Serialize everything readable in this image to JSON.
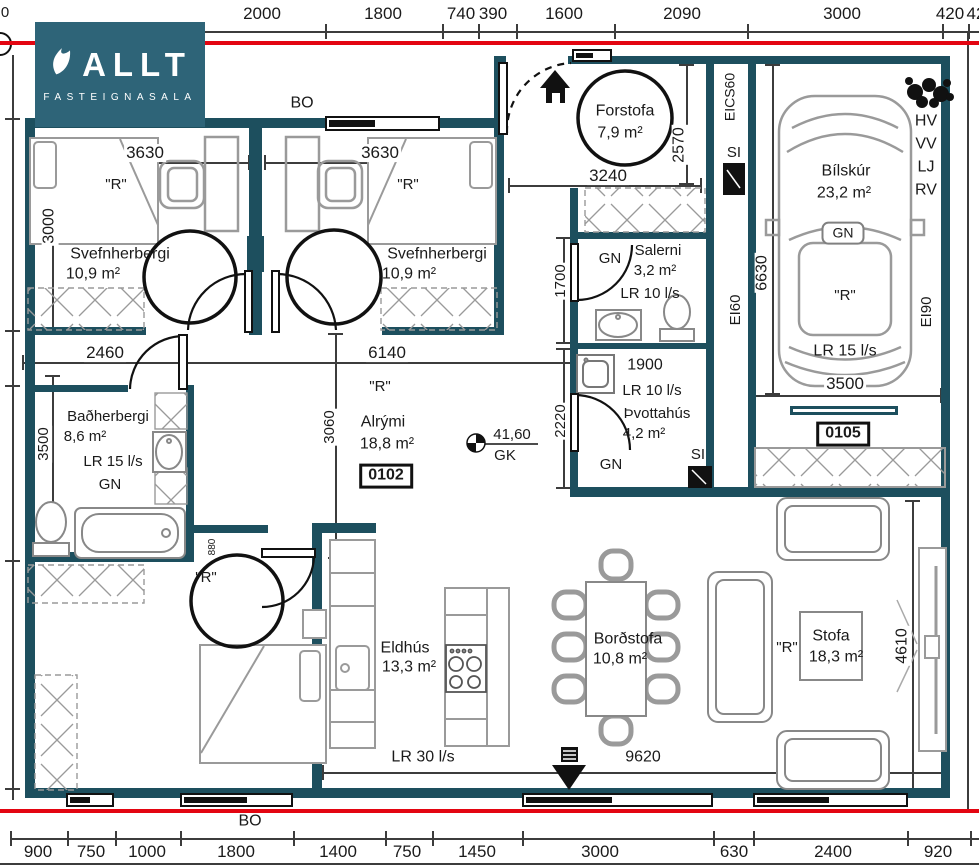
{
  "logo": {
    "brand": "ALLT",
    "sub": "FASTEIGNASALA"
  },
  "colors": {
    "wall": "#1d4f5e",
    "logo_bg": "#2e6478",
    "red_line": "#e30511",
    "furniture": "#9a9a9a"
  },
  "annotations": [
    {
      "n": "dim-top-2000",
      "t": "2000",
      "x": 262,
      "y": 14,
      "s": 17
    },
    {
      "n": "dim-top-1800",
      "t": "1800",
      "x": 383,
      "y": 14,
      "s": 17
    },
    {
      "n": "dim-top-740",
      "t": "740",
      "x": 461,
      "y": 14,
      "s": 17
    },
    {
      "n": "dim-top-390",
      "t": "390",
      "x": 493,
      "y": 14,
      "s": 17
    },
    {
      "n": "dim-top-1600",
      "t": "1600",
      "x": 564,
      "y": 14,
      "s": 17
    },
    {
      "n": "dim-top-2090",
      "t": "2090",
      "x": 682,
      "y": 14,
      "s": 17
    },
    {
      "n": "dim-top-3000",
      "t": "3000",
      "x": 842,
      "y": 14,
      "s": 17
    },
    {
      "n": "dim-top-420",
      "t": "420",
      "x": 950,
      "y": 14,
      "s": 17
    },
    {
      "n": "dim-top-partial",
      "t": "42",
      "x": 976,
      "y": 14,
      "s": 17
    },
    {
      "n": "dim-left-partial",
      "t": "0",
      "x": 5,
      "y": 13,
      "s": 15
    },
    {
      "n": "label-bo-top",
      "t": "BO",
      "x": 302,
      "y": 104,
      "s": 16
    },
    {
      "n": "dim-3630-left",
      "t": "3630",
      "x": 145,
      "y": 153,
      "s": 17,
      "bg": 1
    },
    {
      "n": "dim-3630-right",
      "t": "3630",
      "x": 380,
      "y": 153,
      "s": 17,
      "bg": 1
    },
    {
      "n": "dim-3000-left",
      "t": "3000",
      "x": 50,
      "y": 226,
      "s": 16,
      "r": -90,
      "bg": 1
    },
    {
      "n": "label-r-bedroom1",
      "t": "\"R\"",
      "x": 116,
      "y": 185,
      "s": 15
    },
    {
      "n": "label-r-bedroom2",
      "t": "\"R\"",
      "x": 408,
      "y": 185,
      "s": 15
    },
    {
      "n": "room-svefnherbergi1",
      "t": "Svefnherbergi",
      "x": 120,
      "y": 255,
      "s": 16
    },
    {
      "n": "area-svefnherbergi1",
      "t": "10,9 m²",
      "x": 93,
      "y": 275,
      "s": 16
    },
    {
      "n": "room-svefnherbergi2",
      "t": "Svefnherbergi",
      "x": 437,
      "y": 255,
      "s": 16
    },
    {
      "n": "area-svefnherbergi2",
      "t": "10,9 m²",
      "x": 409,
      "y": 275,
      "s": 16
    },
    {
      "n": "room-forstofa",
      "t": "Forstofa",
      "x": 625,
      "y": 112,
      "s": 16
    },
    {
      "n": "area-forstofa",
      "t": "7,9 m²",
      "x": 620,
      "y": 134,
      "s": 16
    },
    {
      "n": "dim-3240",
      "t": "3240",
      "x": 608,
      "y": 176,
      "s": 17,
      "bg": 1
    },
    {
      "n": "dim-2570",
      "t": "2570",
      "x": 680,
      "y": 145,
      "s": 16,
      "r": -90,
      "bg": 1
    },
    {
      "n": "label-eics60",
      "t": "EICS60",
      "x": 730,
      "y": 97,
      "s": 14,
      "r": -90
    },
    {
      "n": "label-si-top",
      "t": "SI",
      "x": 734,
      "y": 153,
      "s": 15
    },
    {
      "n": "room-bilskur",
      "t": "Bílskúr",
      "x": 846,
      "y": 172,
      "s": 16
    },
    {
      "n": "area-bilskur",
      "t": "23,2 m²",
      "x": 844,
      "y": 194,
      "s": 16
    },
    {
      "n": "label-gn-car",
      "t": "GN",
      "x": 843,
      "y": 233,
      "s": 14,
      "box": "car"
    },
    {
      "n": "label-r-bilskur",
      "t": "\"R\"",
      "x": 845,
      "y": 296,
      "s": 15
    },
    {
      "n": "label-lr15-bilskur",
      "t": "LR 15 l/s",
      "x": 845,
      "y": 352,
      "s": 16
    },
    {
      "n": "dim-6630",
      "t": "6630",
      "x": 763,
      "y": 273,
      "s": 16,
      "r": -90,
      "bg": 1
    },
    {
      "n": "dim-3500-garage",
      "t": "3500",
      "x": 845,
      "y": 384,
      "s": 17,
      "bg": 1
    },
    {
      "n": "label-ei60",
      "t": "EI60",
      "x": 736,
      "y": 310,
      "s": 15,
      "r": -90
    },
    {
      "n": "label-ei90",
      "t": "EI90",
      "x": 927,
      "y": 312,
      "s": 15,
      "r": -90
    },
    {
      "n": "label-hv",
      "t": "HV",
      "x": 926,
      "y": 122,
      "s": 16
    },
    {
      "n": "label-vv",
      "t": "VV",
      "x": 926,
      "y": 145,
      "s": 16
    },
    {
      "n": "label-lj",
      "t": "LJ",
      "x": 926,
      "y": 168,
      "s": 16
    },
    {
      "n": "label-rv",
      "t": "RV",
      "x": 926,
      "y": 191,
      "s": 16
    },
    {
      "n": "num-0105",
      "t": "0105",
      "x": 843,
      "y": 434,
      "s": 16,
      "box": "num"
    },
    {
      "n": "label-gn-salerni",
      "t": "GN",
      "x": 610,
      "y": 259,
      "s": 15
    },
    {
      "n": "room-salerni",
      "t": "Salerni",
      "x": 658,
      "y": 251,
      "s": 15
    },
    {
      "n": "area-salerni",
      "t": "3,2 m²",
      "x": 655,
      "y": 271,
      "s": 15
    },
    {
      "n": "label-lr10-salerni",
      "t": "LR 10 l/s",
      "x": 650,
      "y": 294,
      "s": 15
    },
    {
      "n": "dim-1700",
      "t": "1700",
      "x": 561,
      "y": 281,
      "s": 15,
      "r": -90,
      "bg": 1
    },
    {
      "n": "dim-1900",
      "t": "1900",
      "x": 645,
      "y": 366,
      "s": 16,
      "bg": 1
    },
    {
      "n": "label-lr10-thvottahus",
      "t": "LR 10 l/s",
      "x": 652,
      "y": 391,
      "s": 15,
      "bg": 1
    },
    {
      "n": "room-thvottahus",
      "t": "Þvottahús",
      "x": 657,
      "y": 414,
      "s": 15
    },
    {
      "n": "area-thvottahus",
      "t": "4,2 m²",
      "x": 644,
      "y": 434,
      "s": 15
    },
    {
      "n": "label-gn-thvottahus",
      "t": "GN",
      "x": 611,
      "y": 465,
      "s": 15
    },
    {
      "n": "label-si-thvottahus",
      "t": "SI",
      "x": 698,
      "y": 455,
      "s": 15
    },
    {
      "n": "dim-2220",
      "t": "2220",
      "x": 561,
      "y": 421,
      "s": 15,
      "r": -90,
      "bg": 1
    },
    {
      "n": "dim-2460",
      "t": "2460",
      "x": 105,
      "y": 353,
      "s": 17,
      "bg": 1
    },
    {
      "n": "dim-6140",
      "t": "6140",
      "x": 387,
      "y": 353,
      "s": 17,
      "bg": 1
    },
    {
      "n": "label-r-alrymi",
      "t": "\"R\"",
      "x": 380,
      "y": 387,
      "s": 15
    },
    {
      "n": "room-alrymi",
      "t": "Alrými",
      "x": 383,
      "y": 423,
      "s": 16
    },
    {
      "n": "area-alrymi",
      "t": "18,8 m²",
      "x": 387,
      "y": 445,
      "s": 16
    },
    {
      "n": "num-0102",
      "t": "0102",
      "x": 386,
      "y": 476,
      "s": 16,
      "box": "num"
    },
    {
      "n": "label-level-41-60",
      "t": "41,60",
      "x": 512,
      "y": 435,
      "s": 15
    },
    {
      "n": "label-gk",
      "t": "GK",
      "x": 505,
      "y": 456,
      "s": 15
    },
    {
      "n": "dim-3060",
      "t": "3060",
      "x": 330,
      "y": 427,
      "s": 15,
      "r": -90,
      "bg": 1
    },
    {
      "n": "room-badherbergi",
      "t": "Baðherbergi",
      "x": 108,
      "y": 417,
      "s": 15
    },
    {
      "n": "area-badherbergi",
      "t": "8,6 m²",
      "x": 85,
      "y": 437,
      "s": 15
    },
    {
      "n": "label-lr15-bad",
      "t": "LR 15 l/s",
      "x": 113,
      "y": 462,
      "s": 15
    },
    {
      "n": "label-gn-bad",
      "t": "GN",
      "x": 110,
      "y": 485,
      "s": 15
    },
    {
      "n": "dim-3500-bad",
      "t": "3500",
      "x": 44,
      "y": 444,
      "s": 15,
      "r": -90,
      "bg": 1
    },
    {
      "n": "dim-880",
      "t": "880",
      "x": 213,
      "y": 547,
      "s": 10,
      "r": -90
    },
    {
      "n": "label-r-bedroom3",
      "t": "\"R\"",
      "x": 206,
      "y": 578,
      "s": 15
    },
    {
      "n": "room-eldhus",
      "t": "Eldhús",
      "x": 405,
      "y": 649,
      "s": 16
    },
    {
      "n": "area-eldhus",
      "t": "13,3 m²",
      "x": 409,
      "y": 668,
      "s": 16
    },
    {
      "n": "room-bordstofa",
      "t": "Borðstofa",
      "x": 628,
      "y": 640,
      "s": 16
    },
    {
      "n": "area-bordstofa",
      "t": "10,8 m²",
      "x": 620,
      "y": 660,
      "s": 16
    },
    {
      "n": "label-r-stofa",
      "t": "\"R\"",
      "x": 787,
      "y": 648,
      "s": 15
    },
    {
      "n": "room-stofa",
      "t": "Stofa",
      "x": 831,
      "y": 637,
      "s": 16
    },
    {
      "n": "area-stofa",
      "t": "18,3 m²",
      "x": 836,
      "y": 658,
      "s": 16
    },
    {
      "n": "dim-4610",
      "t": "4610",
      "x": 903,
      "y": 646,
      "s": 16,
      "r": -90,
      "bg": 1
    },
    {
      "n": "label-lr30",
      "t": "LR 30 l/s",
      "x": 423,
      "y": 758,
      "s": 16,
      "bg": 1
    },
    {
      "n": "dim-9620",
      "t": "9620",
      "x": 643,
      "y": 758,
      "s": 16,
      "bg": 1
    },
    {
      "n": "label-bo-bottom",
      "t": "BO",
      "x": 250,
      "y": 822,
      "s": 16
    },
    {
      "n": "dim-bot-900",
      "t": "900",
      "x": 38,
      "y": 852,
      "s": 17
    },
    {
      "n": "dim-bot-750a",
      "t": "750",
      "x": 91,
      "y": 852,
      "s": 17
    },
    {
      "n": "dim-bot-1000",
      "t": "1000",
      "x": 147,
      "y": 852,
      "s": 17
    },
    {
      "n": "dim-bot-1800",
      "t": "1800",
      "x": 236,
      "y": 852,
      "s": 17
    },
    {
      "n": "dim-bot-1400",
      "t": "1400",
      "x": 338,
      "y": 852,
      "s": 17
    },
    {
      "n": "dim-bot-750b",
      "t": "750",
      "x": 407,
      "y": 852,
      "s": 17
    },
    {
      "n": "dim-bot-1450",
      "t": "1450",
      "x": 477,
      "y": 852,
      "s": 17
    },
    {
      "n": "dim-bot-3000",
      "t": "3000",
      "x": 600,
      "y": 852,
      "s": 17
    },
    {
      "n": "dim-bot-630",
      "t": "630",
      "x": 734,
      "y": 852,
      "s": 17
    },
    {
      "n": "dim-bot-2400",
      "t": "2400",
      "x": 833,
      "y": 852,
      "s": 17
    },
    {
      "n": "dim-bot-920",
      "t": "920",
      "x": 938,
      "y": 852,
      "s": 17
    }
  ]
}
